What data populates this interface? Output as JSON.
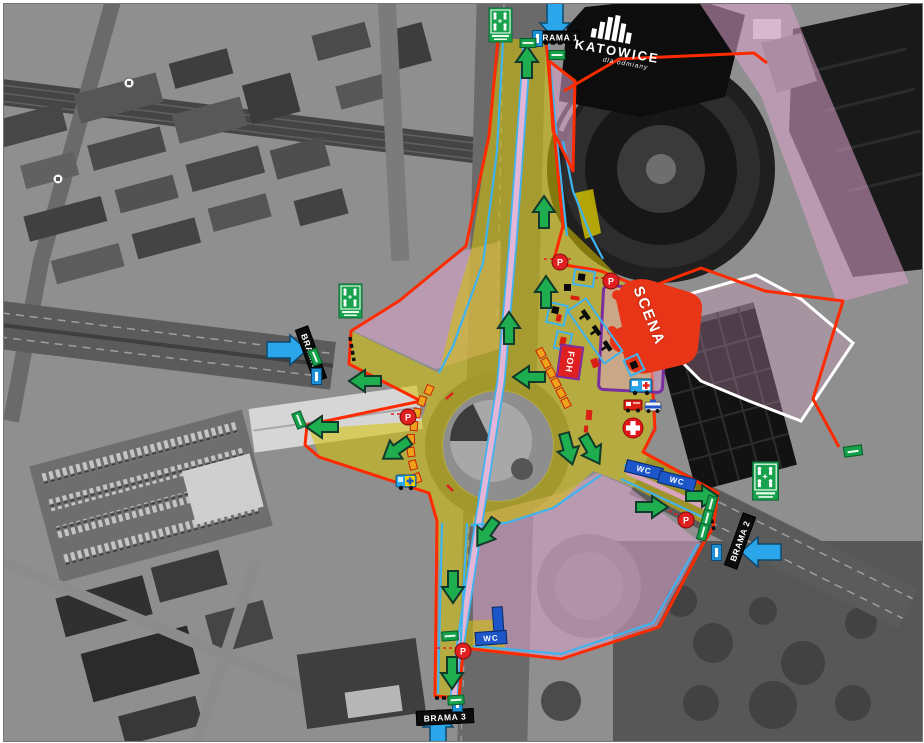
{
  "venue": {
    "name": "KATOWICE",
    "tagline": "dla odmiany"
  },
  "gates": {
    "gate1": "BRAMA 1",
    "gate2": "BRAMA 2",
    "gate3": "BRAMA 3",
    "gate4": "BRAMA 4"
  },
  "labels": {
    "stage": "SCENA",
    "foh": "FOH",
    "wc": "WC",
    "parking": "P"
  },
  "colors": {
    "event_area_overlay": "#d6c300",
    "restricted_overlay": "#dda4cd",
    "boundary_line": "#ff2b00",
    "barrier_line": "#3fb3ef",
    "tram_corridor": "#e3b6d8",
    "evacuation_arrow": "#1fae4f",
    "entry_arrow": "#2ba6ea",
    "gate_label_background": "#0c0c0c",
    "stage_fill": "#e83518",
    "stage_pocket_outline": "#7a2fa0",
    "wc_fill": "#1d56c8",
    "assembly_sign": "#18a24d",
    "toilet_cabin": "#efa21b",
    "first_aid": "#e02020",
    "safe_zone_outline": "#ffffff"
  },
  "icons": {
    "assembly-point-sign": "green square, four figures with arrows to centre",
    "info-point-marker": "blue box with white bar",
    "parking-marker": "red circle with white P",
    "first-aid-icon": "red circle with white cross",
    "ambulance-icon": "blue van with red cross",
    "fire-truck-icon": "red fire engine",
    "police-car-icon": "white car with blue roof bar",
    "medical-vehicle-icon": "blue vehicle with yellow cross plate",
    "portable-toilets-row": "orange cabins in a chained row",
    "evacuation-arrow": "green arrow with dark outline",
    "entry-arrow": "blue arrow",
    "wc-point": "blue bar labelled WC",
    "gate-dashes": "black dashed line across gate",
    "transit-stop-icon": "white circle stop marker"
  }
}
